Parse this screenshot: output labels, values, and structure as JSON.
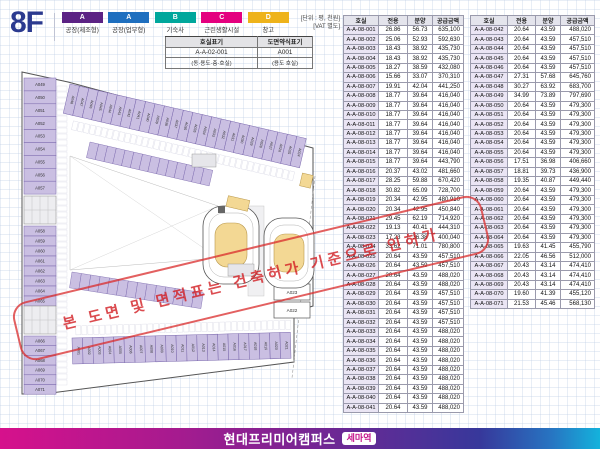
{
  "page": {
    "floor": "8F"
  },
  "legend": [
    {
      "code": "A",
      "label": "공장(제조형)",
      "color": "#5b2284"
    },
    {
      "code": "A",
      "label": "공장(업무형)",
      "color": "#1e6fbf"
    },
    {
      "code": "B",
      "label": "기숙사",
      "color": "#00a79c"
    },
    {
      "code": "C",
      "label": "근린생활시설",
      "color": "#e4007f"
    },
    {
      "code": "D",
      "label": "창고",
      "color": "#eeb31b"
    }
  ],
  "unit_note": {
    "line1": "[단위 : 평, 천원]",
    "line2": "[VAT 별도]"
  },
  "notation_table": {
    "headers": [
      "호실표기",
      "도면약식표기"
    ],
    "values": [
      "A-A-02-001",
      "A001"
    ],
    "notes": [
      "(동·용도·층·호실)",
      "(용도 호실)"
    ]
  },
  "price_table": {
    "headers": [
      "호실",
      "전용",
      "분양",
      "공급금액"
    ],
    "left_rows": [
      [
        "A-A-08-001",
        "26.86",
        "56.73",
        "635,100"
      ],
      [
        "A-A-08-002",
        "25.06",
        "52.93",
        "592,630"
      ],
      [
        "A-A-08-003",
        "18.43",
        "38.92",
        "435,730"
      ],
      [
        "A-A-08-004",
        "18.43",
        "38.92",
        "435,730"
      ],
      [
        "A-A-08-005",
        "18.27",
        "38.59",
        "432,080"
      ],
      [
        "A-A-08-006",
        "15.66",
        "33.07",
        "370,310"
      ],
      [
        "A-A-08-007",
        "19.91",
        "42.04",
        "441,250"
      ],
      [
        "A-A-08-008",
        "18.77",
        "39.64",
        "416,040"
      ],
      [
        "A-A-08-009",
        "18.77",
        "39.64",
        "416,040"
      ],
      [
        "A-A-08-010",
        "18.77",
        "39.64",
        "416,040"
      ],
      [
        "A-A-08-011",
        "18.77",
        "39.64",
        "416,040"
      ],
      [
        "A-A-08-012",
        "18.77",
        "39.64",
        "416,040"
      ],
      [
        "A-A-08-013",
        "18.77",
        "39.64",
        "416,040"
      ],
      [
        "A-A-08-014",
        "18.77",
        "39.64",
        "416,040"
      ],
      [
        "A-A-08-015",
        "18.77",
        "39.64",
        "443,790"
      ],
      [
        "A-A-08-016",
        "20.37",
        "43.02",
        "481,660"
      ],
      [
        "A-A-08-017",
        "28.25",
        "59.88",
        "670,420"
      ],
      [
        "A-A-08-018",
        "30.82",
        "65.09",
        "728,700"
      ],
      [
        "A-A-08-019",
        "20.34",
        "42.95",
        "480,910"
      ],
      [
        "A-A-08-020",
        "20.34",
        "42.95",
        "450,840"
      ],
      [
        "A-A-08-021",
        "29.45",
        "62.19",
        "714,920"
      ],
      [
        "A-A-08-022",
        "19.13",
        "40.41",
        "444,310"
      ],
      [
        "A-A-08-023",
        "17.23",
        "36.38",
        "400,040"
      ],
      [
        "A-A-08-024",
        "33.62",
        "71.01",
        "780,800"
      ],
      [
        "A-A-08-025",
        "20.64",
        "43.59",
        "457,510"
      ],
      [
        "A-A-08-026",
        "20.64",
        "43.59",
        "457,510"
      ],
      [
        "A-A-08-027",
        "20.64",
        "43.59",
        "488,020"
      ],
      [
        "A-A-08-028",
        "20.64",
        "43.59",
        "488,020"
      ],
      [
        "A-A-08-029",
        "20.64",
        "43.59",
        "457,510"
      ],
      [
        "A-A-08-030",
        "20.64",
        "43.59",
        "457,510"
      ],
      [
        "A-A-08-031",
        "20.64",
        "43.59",
        "457,510"
      ],
      [
        "A-A-08-032",
        "20.64",
        "43.59",
        "457,510"
      ],
      [
        "A-A-08-033",
        "20.64",
        "43.59",
        "488,020"
      ],
      [
        "A-A-08-034",
        "20.64",
        "43.59",
        "488,020"
      ],
      [
        "A-A-08-035",
        "20.64",
        "43.59",
        "488,020"
      ],
      [
        "A-A-08-036",
        "20.64",
        "43.59",
        "488,020"
      ],
      [
        "A-A-08-037",
        "20.64",
        "43.59",
        "488,020"
      ],
      [
        "A-A-08-038",
        "20.64",
        "43.59",
        "488,020"
      ],
      [
        "A-A-08-039",
        "20.64",
        "43.59",
        "488,020"
      ],
      [
        "A-A-08-040",
        "20.64",
        "43.59",
        "488,020"
      ],
      [
        "A-A-08-041",
        "20.64",
        "43.59",
        "488,020"
      ]
    ],
    "right_rows": [
      [
        "A-A-08-042",
        "20.64",
        "43.59",
        "488,020"
      ],
      [
        "A-A-08-043",
        "20.64",
        "43.59",
        "457,510"
      ],
      [
        "A-A-08-044",
        "20.64",
        "43.59",
        "457,510"
      ],
      [
        "A-A-08-045",
        "20.64",
        "43.59",
        "457,510"
      ],
      [
        "A-A-08-046",
        "20.64",
        "43.59",
        "457,510"
      ],
      [
        "A-A-08-047",
        "27.31",
        "57.68",
        "645,760"
      ],
      [
        "A-A-08-048",
        "30.27",
        "63.92",
        "683,700"
      ],
      [
        "A-A-08-049",
        "34.99",
        "73.89",
        "797,690"
      ],
      [
        "A-A-08-050",
        "20.64",
        "43.59",
        "479,300"
      ],
      [
        "A-A-08-051",
        "20.64",
        "43.59",
        "479,300"
      ],
      [
        "A-A-08-052",
        "20.64",
        "43.59",
        "479,300"
      ],
      [
        "A-A-08-053",
        "20.64",
        "43.59",
        "479,300"
      ],
      [
        "A-A-08-054",
        "20.64",
        "43.59",
        "479,300"
      ],
      [
        "A-A-08-055",
        "20.64",
        "43.59",
        "479,300"
      ],
      [
        "A-A-08-056",
        "17.51",
        "36.98",
        "406,660"
      ],
      [
        "A-A-08-057",
        "18.81",
        "39.73",
        "436,900"
      ],
      [
        "A-A-08-058",
        "19.35",
        "40.87",
        "449,440"
      ],
      [
        "A-A-08-059",
        "20.64",
        "43.59",
        "479,300"
      ],
      [
        "A-A-08-060",
        "20.64",
        "43.59",
        "479,300"
      ],
      [
        "A-A-08-061",
        "20.64",
        "43.59",
        "479,300"
      ],
      [
        "A-A-08-062",
        "20.64",
        "43.59",
        "479,300"
      ],
      [
        "A-A-08-063",
        "20.64",
        "43.59",
        "479,300"
      ],
      [
        "A-A-08-064",
        "20.64",
        "43.59",
        "479,300"
      ],
      [
        "A-A-08-065",
        "19.63",
        "41.45",
        "455,790"
      ],
      [
        "A-A-08-066",
        "22.05",
        "46.56",
        "512,000"
      ],
      [
        "A-A-08-067",
        "20.43",
        "43.14",
        "474,410"
      ],
      [
        "A-A-08-068",
        "20.43",
        "43.14",
        "474,410"
      ],
      [
        "A-A-08-069",
        "20.43",
        "43.14",
        "474,410"
      ],
      [
        "A-A-08-070",
        "19.60",
        "41.39",
        "455,120"
      ],
      [
        "A-A-08-071",
        "21.53",
        "45.46",
        "568,130"
      ]
    ]
  },
  "plan": {
    "left_rooms_a": [
      "A049",
      "A050",
      "A051",
      "A052",
      "A053",
      "A054",
      "A055",
      "A056",
      "A057"
    ],
    "left_rooms_b": [
      "A058",
      "A059",
      "A060",
      "A061",
      "A062",
      "A063",
      "A064",
      "A065"
    ],
    "left_rooms_c": [
      "A066",
      "A067",
      "A068",
      "A069",
      "A070",
      "A071"
    ],
    "top_rooms": [
      "A048",
      "A047",
      "A046",
      "A045",
      "A044",
      "A043",
      "A042",
      "A041",
      "A040",
      "A039",
      "A038",
      "A037",
      "A036",
      "A035",
      "A034",
      "A033",
      "A032",
      "A031",
      "A030",
      "A029",
      "A028",
      "A027",
      "A026",
      "A025",
      "A024"
    ],
    "bottom_rooms": [
      "A001",
      "A002",
      "A003",
      "A004",
      "A005",
      "A006",
      "A007",
      "A008",
      "A009",
      "A010",
      "A011",
      "A012",
      "A013",
      "A014",
      "A015",
      "A016",
      "A017",
      "A018",
      "A019",
      "A020",
      "A021"
    ],
    "right_rooms": [
      "A023",
      "A022"
    ],
    "stamp_text": "본 도면 및 면적표는 건축허가 기준으로 인허가",
    "colors": {
      "unit_fill": "#cabfe2",
      "unit_stroke": "#7a68ad",
      "ramp_fill": "#f3d894",
      "ramp_stroke": "#b9984d",
      "stamp_red": "#d92b2b"
    }
  },
  "footer": {
    "title": "현대프리미어캠퍼스",
    "badge": "세마역"
  }
}
